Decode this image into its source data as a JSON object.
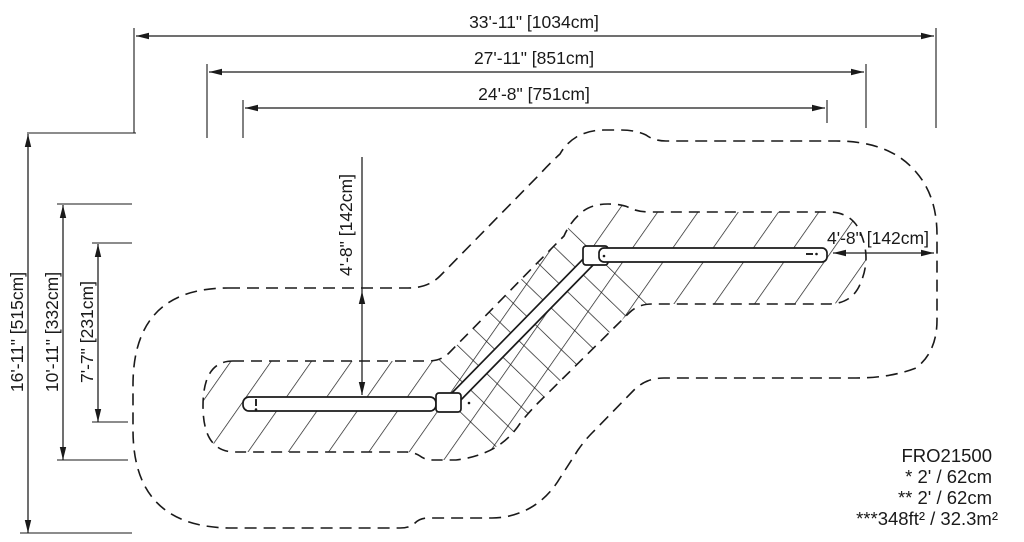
{
  "diagram": {
    "product_code": "FRO21500",
    "notes": [
      "* 2' / 62cm",
      "** 2' / 62cm",
      "***348ft² / 32.3m²"
    ],
    "dimensions": {
      "top": [
        {
          "label": "33'-11\" [1034cm]"
        },
        {
          "label": "27'-11\" [851cm]"
        },
        {
          "label": "24'-8\" [751cm]"
        }
      ],
      "left": [
        {
          "label": "16'-11\" [515cm]"
        },
        {
          "label": "10'-11\" [332cm]"
        },
        {
          "label": "7'-7\" [231cm]"
        }
      ],
      "inner_vertical": {
        "label": "4'-8\" [142cm]"
      },
      "inner_horizontal": {
        "label": "4'-8\" [142cm]"
      }
    },
    "colors": {
      "ink": "#1a1a1a",
      "paper": "#ffffff"
    }
  }
}
